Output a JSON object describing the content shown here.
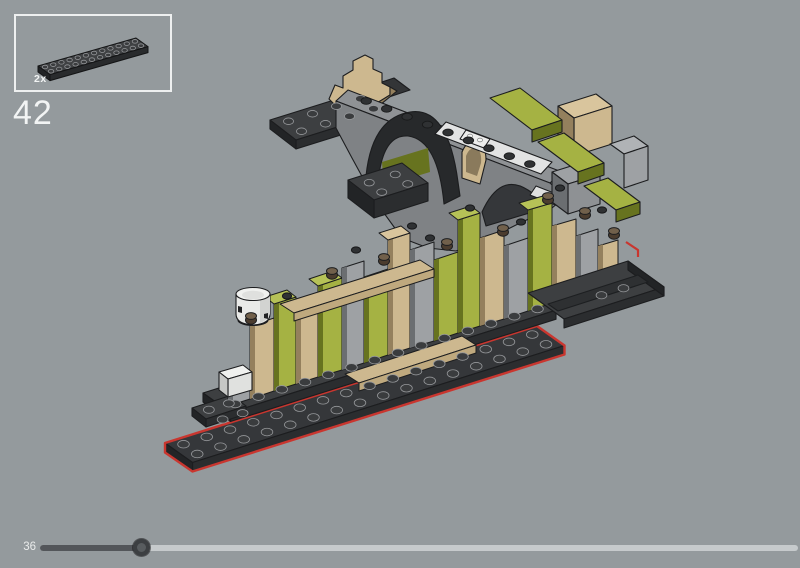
{
  "app": {
    "background": "#949a9d"
  },
  "parts_panel": {
    "parts": [
      {
        "name": "plate-2x14-dark-gray",
        "count_label": "2x"
      }
    ]
  },
  "step": {
    "number": "42"
  },
  "progress": {
    "current_step_label": "36",
    "percent": 13.4
  },
  "palette": {
    "bg": "#949a9d",
    "panelBorder": "#eef0f0",
    "text": "#f2f4f4",
    "label": "#e9ebeb",
    "red": "#c9362f",
    "darkTop": "#3d3f41",
    "darkFront": "#2b2d2f",
    "darkLeft": "#222426",
    "darkTile": "#2e3032",
    "stud": "#3a3c3e",
    "studEdge": "#95979a",
    "outline": "#1c1d1f",
    "olive": "#a5b243",
    "oliveMid": "#93a135",
    "oliveDark": "#67731f",
    "oliveCap": "#b6c257",
    "tan": "#cdb88f",
    "tanMid": "#bfa97e",
    "tanDark": "#94805d",
    "tanCap": "#d9c59d",
    "gray": "#9ea1a4",
    "grayMid": "#8e9194",
    "grayDark": "#6b6e71",
    "grayCap": "#b0b3b6",
    "wallFace": "#7f8285",
    "wallTop": "#8f9295",
    "archDark": "#27292b",
    "white": "#e9eae8",
    "whiteShade": "#d2d3d1",
    "brown": "#4b3c2e",
    "brownTop": "#71604b",
    "trackLight": "#c6cacc",
    "trackDark": "#53565a",
    "thumbOuter": "#3c3f42",
    "thumbInner": "#585c5f"
  },
  "model": {
    "strips": [
      {
        "x0": 228,
        "x1": 250,
        "t0": 384,
        "t1": 377,
        "b0": 406,
        "b1": 399,
        "c": "gray"
      },
      {
        "x0": 250,
        "x1": 274,
        "t0": 326,
        "t1": 318,
        "b0": 399,
        "b1": 391,
        "c": "tan"
      },
      {
        "x0": 274,
        "x1": 296,
        "t0": 304,
        "t1": 297,
        "b0": 391,
        "b1": 384,
        "c": "olive",
        "cap": true
      },
      {
        "x0": 296,
        "x1": 318,
        "t0": 314,
        "t1": 307,
        "b0": 384,
        "b1": 377,
        "c": "tan"
      },
      {
        "x0": 318,
        "x1": 342,
        "t0": 286,
        "t1": 278,
        "b0": 377,
        "b1": 370,
        "c": "olive",
        "cap": true
      },
      {
        "x0": 342,
        "x1": 364,
        "t0": 268,
        "t1": 261,
        "b0": 370,
        "b1": 363,
        "c": "gray"
      },
      {
        "x0": 364,
        "x1": 388,
        "t0": 277,
        "t1": 269,
        "b0": 363,
        "b1": 355,
        "c": "olive"
      },
      {
        "x0": 388,
        "x1": 410,
        "t0": 240,
        "t1": 233,
        "b0": 355,
        "b1": 348,
        "c": "tan",
        "cap": true
      },
      {
        "x0": 410,
        "x1": 434,
        "t0": 250,
        "t1": 242,
        "b0": 348,
        "b1": 341,
        "c": "gray"
      },
      {
        "x0": 434,
        "x1": 458,
        "t0": 260,
        "t1": 252,
        "b0": 341,
        "b1": 333,
        "c": "olive"
      },
      {
        "x0": 458,
        "x1": 480,
        "t0": 220,
        "t1": 213,
        "b0": 333,
        "b1": 326,
        "c": "olive",
        "cap": true
      },
      {
        "x0": 480,
        "x1": 504,
        "t0": 238,
        "t1": 230,
        "b0": 326,
        "b1": 319,
        "c": "tan"
      },
      {
        "x0": 504,
        "x1": 528,
        "t0": 246,
        "t1": 238,
        "b0": 319,
        "b1": 311,
        "c": "gray"
      },
      {
        "x0": 528,
        "x1": 552,
        "t0": 210,
        "t1": 203,
        "b0": 311,
        "b1": 303,
        "c": "olive",
        "cap": true
      },
      {
        "x0": 552,
        "x1": 576,
        "t0": 226,
        "t1": 219,
        "b0": 303,
        "b1": 296,
        "c": "tan"
      },
      {
        "x0": 576,
        "x1": 598,
        "t0": 236,
        "t1": 229,
        "b0": 296,
        "b1": 289,
        "c": "gray"
      },
      {
        "x0": 598,
        "x1": 618,
        "t0": 246,
        "t1": 240,
        "b0": 289,
        "b1": 283,
        "c": "tan"
      }
    ],
    "quads": [
      {
        "p": [
          [
            280,
            304
          ],
          [
            420,
            260
          ],
          [
            434,
            269
          ],
          [
            294,
            313
          ]
        ],
        "c": "tan"
      },
      {
        "p": [
          [
            294,
            313
          ],
          [
            434,
            269
          ],
          [
            434,
            277
          ],
          [
            294,
            321
          ]
        ],
        "c": "tanMid"
      },
      {
        "p": [
          [
            345,
            374
          ],
          [
            462,
            336
          ],
          [
            476,
            345
          ],
          [
            359,
            383
          ]
        ],
        "c": "tan"
      },
      {
        "p": [
          [
            359,
            383
          ],
          [
            476,
            345
          ],
          [
            476,
            353
          ],
          [
            359,
            391
          ]
        ],
        "c": "tanMid"
      }
    ],
    "stud_grids": [
      {
        "g": "mini",
        "ax": 22,
        "ay": 50,
        "cols": 12,
        "rows": 2,
        "ex": [
          8.17,
          -2.33
        ],
        "ey": [
          6,
          4.3
        ],
        "rx": 2.7,
        "ry": 1.8
      },
      {
        "g": "A",
        "ax": 270,
        "ay": 120,
        "cols": 4,
        "rows": 2,
        "ex": [
          24,
          -7.5
        ],
        "ey": [
          13,
          10
        ],
        "rx": 5,
        "ry": 3.3
      },
      {
        "g": "A",
        "ax": 350,
        "ay": 182,
        "cols": 2,
        "rows": 2,
        "ex": [
          26,
          -8.2
        ],
        "ey": [
          12.5,
          9.5
        ],
        "rx": 5,
        "ry": 3.3
      },
      {
        "g": "B",
        "ax": 165,
        "ay": 443,
        "cols": 16,
        "rows": 2,
        "ex": [
          23.25,
          -7.31
        ],
        "ey": [
          13.75,
          9.75
        ],
        "rx": 5.8,
        "ry": 3.8
      },
      {
        "g": "B",
        "ax": 203,
        "ay": 393,
        "cols": 14,
        "rows": 1,
        "j0": 1,
        "ex": [
          23.25,
          -7.31
        ],
        "ey": [
          13.75,
          9.75
        ],
        "rx": 5.8,
        "ry": 3.8
      },
      {
        "g": "B",
        "ax": 192,
        "ay": 408,
        "cols": 2,
        "rows": 2,
        "ex": [
          20,
          -6.3
        ],
        "ey": [
          13.75,
          9.75
        ],
        "rx": 5.4,
        "ry": 3.6
      },
      {
        "g": "B",
        "ax": 584,
        "ay": 294,
        "cols": 2,
        "rows": 1,
        "ex": [
          22,
          -7
        ],
        "ey": [
          13,
          9.5
        ],
        "rx": 5.4,
        "ry": 3.6
      }
    ],
    "stud_rows": [
      {
        "g": "A",
        "from": [
          356,
          97
        ],
        "to": [
          540,
          168
        ],
        "n": 9,
        "rx": 5.2,
        "ry": 3.4
      }
    ],
    "barrel_studs": [
      [
        251,
        318
      ],
      [
        332,
        273
      ],
      [
        384,
        259
      ],
      [
        447,
        244
      ],
      [
        503,
        230
      ],
      [
        548,
        198
      ],
      [
        585,
        213
      ],
      [
        614,
        233
      ]
    ],
    "round_studs": [
      [
        287,
        296
      ],
      [
        356,
        250
      ],
      [
        412,
        226
      ],
      [
        470,
        208
      ],
      [
        521,
        222
      ],
      [
        560,
        188
      ],
      [
        602,
        210
      ],
      [
        430,
        238
      ]
    ]
  }
}
